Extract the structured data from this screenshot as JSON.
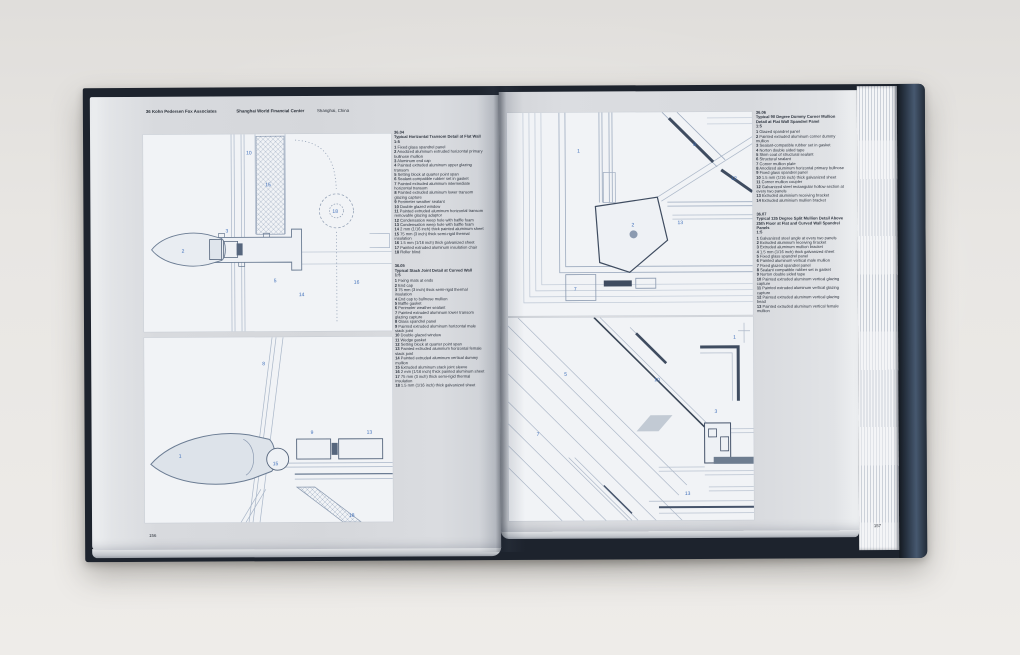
{
  "colors": {
    "cover_navy": "#1d232d",
    "cover_steel_blue": "#46586f",
    "page_gray": "#d8dade",
    "panel_white": "#f1f3f6",
    "line_light": "#a9b6c8",
    "line_dark": "#45536a",
    "callout_blue": "#3f6fba"
  },
  "header": {
    "index": "36",
    "firm": "Kohn Pedersen Fox Associates",
    "project": "Shanghai World Financial Center",
    "location": "Shanghai, China"
  },
  "page_numbers": {
    "left": "156",
    "right": "157"
  },
  "left_page": {
    "sections": [
      {
        "id": "36.04",
        "title": "Typical Horizontal Transom Detail at Flat Wall",
        "scale": "1:5",
        "items": [
          "1 Fixed glass spandrel panel",
          "2 Anodized aluminum extruded horizontal primary bullnose mullion",
          "3 Aluminum end cap",
          "4 Painted extruded aluminum upper glazing transom",
          "5 Setting block at quarter point span",
          "6 Sealant-compatible rubber set in gasket",
          "7 Painted extruded aluminum intermediate horizontal transom",
          "8 Painted extruded aluminum lower transom glazing capture",
          "9 Perimeter weather sealant",
          "10 Double glazed window",
          "11 Painted extruded aluminum horizontal transom removable glazing adaptor",
          "12 Condensation weep hole with baffle foam",
          "13 Condensation weep hole with baffle foam",
          "14 2 mm (1/16 inch) thick painted aluminum sheet",
          "15 75 mm (3 inch) thick semi-rigid thermal insulation",
          "16 1.5 mm (1/16 inch) thick galvanized sheet",
          "17 Painted extruded aluminum insulation chair",
          "18 Roller blind"
        ]
      },
      {
        "id": "36.05",
        "title": "Typical Stack Joint Detail at Curved Wall",
        "scale": "1:5",
        "items": [
          "1 Fixing mats at ends",
          "2 End cap",
          "3 75 mm (3 inch) thick semi-rigid thermal insulation",
          "4 End cap to bullnose mullion",
          "5 Baffle gasket",
          "6 Perimeter weather sealant",
          "7 Painted extruded aluminum lower transom glazing capture",
          "8 Glass spandrel panel",
          "9 Painted extruded aluminum horizontal male stack joint",
          "10 Double glazed window",
          "11 Wedge gasket",
          "12 Setting block at quarter point span",
          "13 Painted extruded aluminum horizontal female stack joint",
          "14 Painted extruded aluminum vertical dummy mullion",
          "15 Extruded aluminum stack joint sleeve",
          "16 2 mm (1/16 inch) thick painted aluminum sheet",
          "17 75 mm (3 inch) thick semi-rigid thermal insulation",
          "18 1.5 mm (1/16 inch) thick galvanized sheet"
        ]
      }
    ]
  },
  "right_page": {
    "sections": [
      {
        "id": "36.06",
        "title": "Typical 90 Degree Dummy Corner Mullion Detail at Flat Wall Spandrel Panel",
        "scale": "1:5",
        "items": [
          "1 Glazed spandrel panel",
          "2 Painted extruded aluminum corner dummy mullion",
          "3 Sealant-compatible rubber set in gasket",
          "4 Norton double sided tape",
          "5 Skim coat of structural sealant",
          "6 Structural sealant",
          "7 Corner mullion plate",
          "8 Anodized aluminum horizontal primary bullnose",
          "9 Fixed glass spandrel panel",
          "10 1.5 mm (1/16 inch) thick galvanized sheet",
          "11 Corner mullion coupler",
          "12 Galvanized steel rectangular hollow section at every two panels",
          "13 Extruded aluminium receiving bracket",
          "14 Extruded aluminium mullion bracket"
        ]
      },
      {
        "id": "36.07",
        "title": "Typical 135 Degree Split Mullion Detail Above 25th Floor at Flat and Curved Wall Spandrel Panels",
        "scale": "1:5",
        "items": [
          "1 Galvanized steel angle at every two panels",
          "2 Extruded aluminum receiving bracket",
          "3 Extruded aluminum mullion bracket",
          "4 1.5 mm (1/16 inch) thick galvanized sheet",
          "5 Fixed glass spandrel panel",
          "6 Painted aluminum vertical male mullion",
          "7 Fixed glazed spandrel panel",
          "8 Sealant compatible rubber set in gasket",
          "9 Norton double sided tape",
          "10 Painted extruded aluminum vertical glazing capture",
          "11 Painted extruded aluminum vertical glazing capture",
          "12 Painted extruded aluminum vertical glazing bead",
          "13 Painted extruded aluminum vertical female mullion"
        ]
      }
    ]
  },
  "drawings": {
    "d1": {
      "callouts": [
        "2",
        "3",
        "15",
        "10",
        "18",
        "5",
        "14",
        "16"
      ]
    },
    "d2": {
      "callouts": [
        "1",
        "8",
        "9",
        "15",
        "18",
        "13"
      ]
    },
    "d3": {
      "callouts": [
        "1",
        "2",
        "7",
        "8",
        "12",
        "13"
      ]
    },
    "d4": {
      "callouts": [
        "1",
        "3",
        "5",
        "7",
        "10",
        "13"
      ]
    }
  }
}
